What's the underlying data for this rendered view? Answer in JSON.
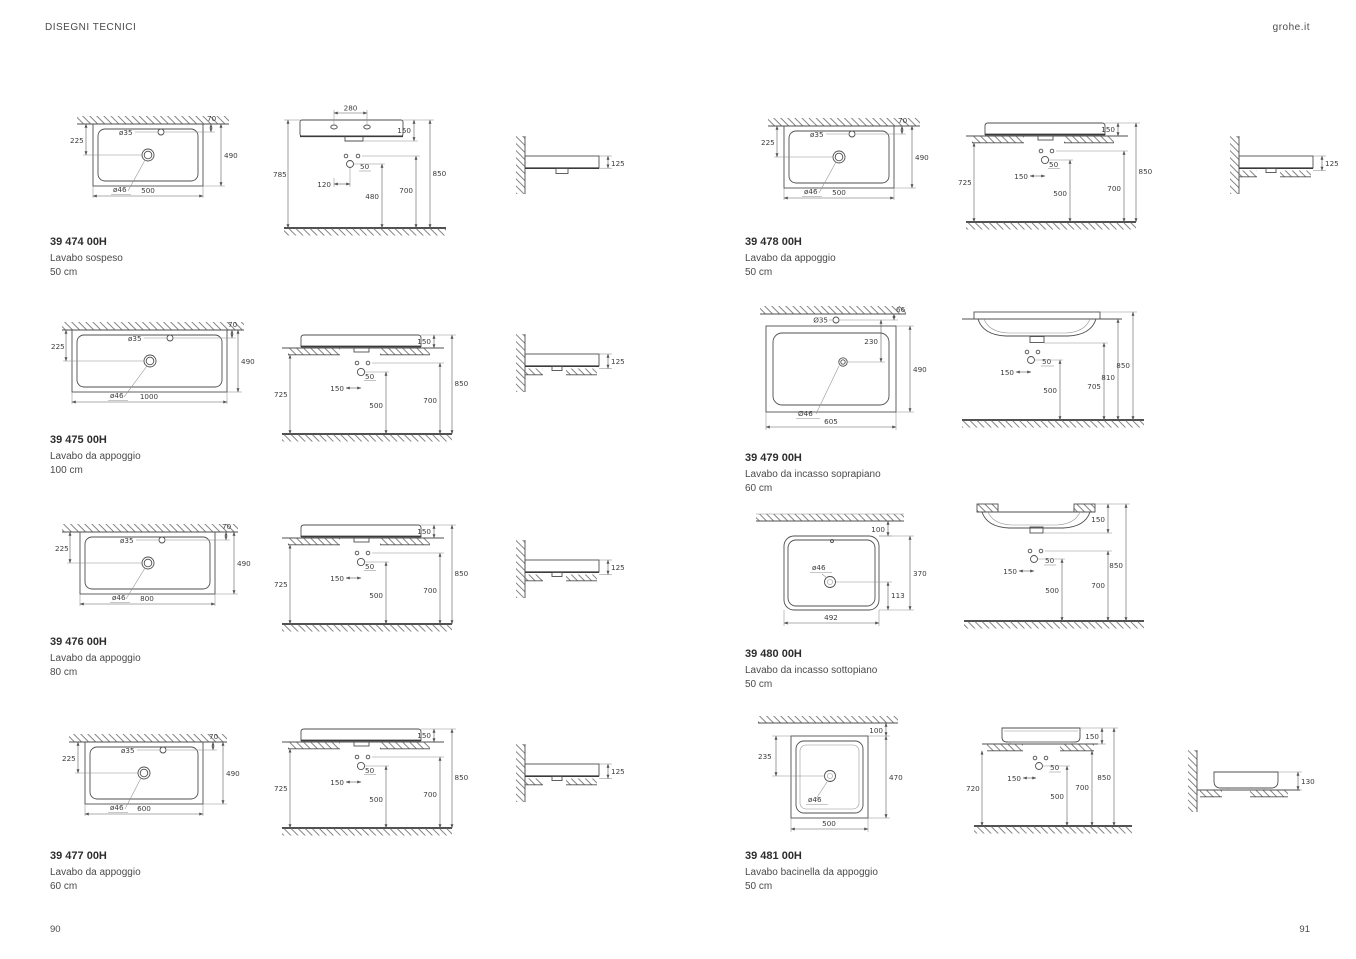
{
  "header": {
    "left": "DISEGNI TECNICI",
    "right": "grohe.it"
  },
  "footer": {
    "left_page": "90",
    "right_page": "91"
  },
  "products": [
    {
      "code": "39 474 00H",
      "name": "Lavabo sospeso",
      "size": "50 cm",
      "plan": {
        "offset_left": "225",
        "faucet_hole": "ø35",
        "wall_gap": "70",
        "depth": "490",
        "drain_hole": "ø46",
        "width": "500"
      },
      "front": {
        "hole_spacing": "280",
        "rim_height": "150",
        "left_height": "785",
        "supply_spacing": "120",
        "hot_cold_gap": "50",
        "outlet_height": "480",
        "supply_height": "700",
        "total_height": "850"
      },
      "side": {
        "edge_height": "125"
      }
    },
    {
      "code": "39 475 00H",
      "name": "Lavabo da appoggio",
      "size": "100 cm",
      "plan": {
        "offset_left": "225",
        "faucet_hole": "ø35",
        "wall_gap": "70",
        "depth": "490",
        "drain_hole": "ø46",
        "width": "1000"
      },
      "front": {
        "rim_height": "150",
        "left_height": "725",
        "supply_spacing": "150",
        "hot_cold_gap": "50",
        "outlet_height": "500",
        "supply_height": "700",
        "total_height": "850"
      },
      "side": {
        "edge_height": "125"
      }
    },
    {
      "code": "39 476 00H",
      "name": "Lavabo da appoggio",
      "size": "80 cm",
      "plan": {
        "offset_left": "225",
        "faucet_hole": "ø35",
        "wall_gap": "70",
        "depth": "490",
        "drain_hole": "ø46",
        "width": "800"
      },
      "front": {
        "rim_height": "150",
        "left_height": "725",
        "supply_spacing": "150",
        "hot_cold_gap": "50",
        "outlet_height": "500",
        "supply_height": "700",
        "total_height": "850"
      },
      "side": {
        "edge_height": "125"
      }
    },
    {
      "code": "39 477 00H",
      "name": "Lavabo da appoggio",
      "size": "60 cm",
      "plan": {
        "offset_left": "225",
        "faucet_hole": "ø35",
        "wall_gap": "70",
        "depth": "490",
        "drain_hole": "ø46",
        "width": "600"
      },
      "front": {
        "rim_height": "150",
        "left_height": "725",
        "supply_spacing": "150",
        "hot_cold_gap": "50",
        "outlet_height": "500",
        "supply_height": "700",
        "total_height": "850"
      },
      "side": {
        "edge_height": "125"
      }
    },
    {
      "code": "39 478 00H",
      "name": "Lavabo da appoggio",
      "size": "50 cm",
      "plan": {
        "offset_left": "225",
        "faucet_hole": "ø35",
        "wall_gap": "70",
        "depth": "490",
        "drain_hole": "ø46",
        "width": "500"
      },
      "front": {
        "rim_height": "150",
        "left_height": "725",
        "supply_spacing": "150",
        "hot_cold_gap": "50",
        "outlet_height": "500",
        "supply_height": "700",
        "total_height": "850"
      },
      "side": {
        "edge_height": "125"
      }
    },
    {
      "code": "39 479 00H",
      "name": "Lavabo da incasso soprapiano",
      "size": "60 cm",
      "plan": {
        "faucet_hole": "Ø35",
        "wall_gap": "66",
        "faucet_to_drain": "230",
        "depth": "490",
        "drain_hole": "Ø46",
        "width": "605"
      },
      "front": {
        "supply_spacing": "150",
        "hot_cold_gap": "50",
        "outlet_height": "500",
        "bowl_bottom_height": "705",
        "counter_height": "810",
        "total_height": "850"
      }
    },
    {
      "code": "39 480 00H",
      "name": "Lavabo da incasso sottopiano",
      "size": "50 cm",
      "plan": {
        "wall_gap": "100",
        "drain_hole": "ø46",
        "depth": "370",
        "drain_offset": "113",
        "width": "492"
      },
      "front": {
        "rim_height": "150",
        "supply_spacing": "150",
        "hot_cold_gap": "50",
        "outlet_height": "500",
        "supply_height": "700",
        "total_height": "850"
      }
    },
    {
      "code": "39 481 00H",
      "name": "Lavabo bacinella da appoggio",
      "size": "50 cm",
      "plan": {
        "wall_gap": "100",
        "offset_left": "235",
        "depth": "470",
        "drain_hole": "ø46",
        "width": "500"
      },
      "front": {
        "rim_height": "150",
        "left_height": "720",
        "supply_spacing": "150",
        "hot_cold_gap": "50",
        "outlet_height": "500",
        "supply_height": "700",
        "total_height": "850"
      },
      "side": {
        "edge_height": "130"
      }
    }
  ]
}
